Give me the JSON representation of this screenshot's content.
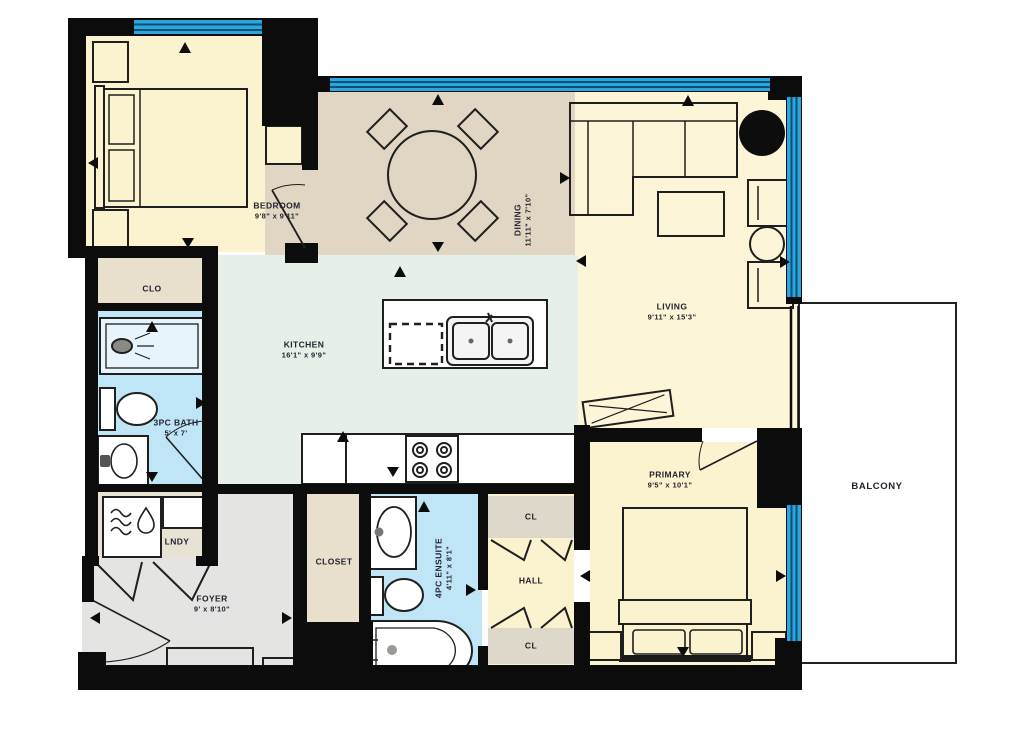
{
  "title": "Two Bedroom Condo Floor Plan",
  "colors": {
    "wall": "#0c0c0c",
    "window": "#2aa7dc",
    "window_stripe": "#0c4e74",
    "floor_cream": "#fbf2cf",
    "floor_living": "#fdf5d7",
    "floor_tan": "#e0d6c3",
    "floor_mint": "#e7f0e8",
    "floor_bath_blue": "#bfe5f6",
    "floor_beige": "#e9dfcd",
    "floor_gray": "#e4e4e3",
    "label_text": "#23232e"
  },
  "icons": {
    "direction_arrow": "triangle",
    "washer_icon": "waves-and-drop"
  },
  "rooms": {
    "bedroom": {
      "name": "BEDROOM",
      "dims": "9'8\" x 9'11\""
    },
    "dining": {
      "name": "DINING",
      "dims": "11'11\" x 7'10\""
    },
    "living": {
      "name": "LIVING",
      "dims": "9'11\" x 15'3\""
    },
    "kitchen": {
      "name": "KITCHEN",
      "dims": "16'1\" x 9'9\""
    },
    "bath": {
      "name": "3PC BATH",
      "dims": "5' x 7'"
    },
    "clo": {
      "name": "CLO"
    },
    "lndy": {
      "name": "LNDY"
    },
    "foyer": {
      "name": "FOYER",
      "dims": "9' x 8'10\""
    },
    "closet": {
      "name": "CLOSET"
    },
    "ensuite": {
      "name": "4PC ENSUITE",
      "dims": "4'11\" x 8'1\""
    },
    "hall": {
      "name": "HALL"
    },
    "cl_upper": {
      "name": "CL"
    },
    "cl_lower": {
      "name": "CL"
    },
    "primary": {
      "name": "PRIMARY",
      "dims": "9'5\" x 10'1\""
    },
    "balcony": {
      "name": "BALCONY"
    }
  }
}
